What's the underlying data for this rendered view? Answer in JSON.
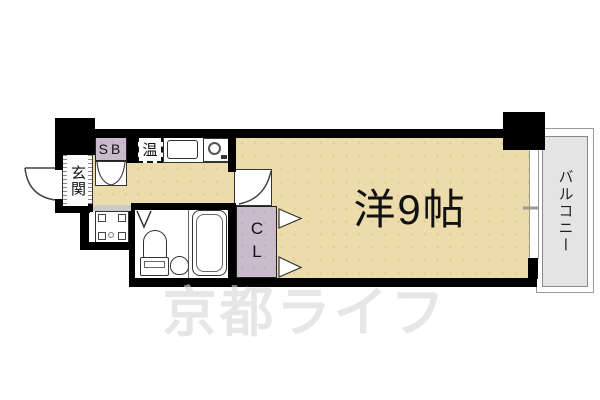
{
  "plan": {
    "labels": {
      "main_room": "洋9帖",
      "entrance": "玄関",
      "balcony": "バルコニー",
      "closet": "CL",
      "shoe_box": "SB",
      "water_heater": "温"
    },
    "watermark": "京都ライフ",
    "colors": {
      "floor": "#ecdcab",
      "floor-dot": "#dcc68f",
      "closet-fill": "#c9bacc",
      "closet-dot": "#bba8bf",
      "balcony-fill": "#e4e4e4",
      "wall": "#000000",
      "line": "#333333",
      "watermark": "#d8d8d8"
    }
  }
}
